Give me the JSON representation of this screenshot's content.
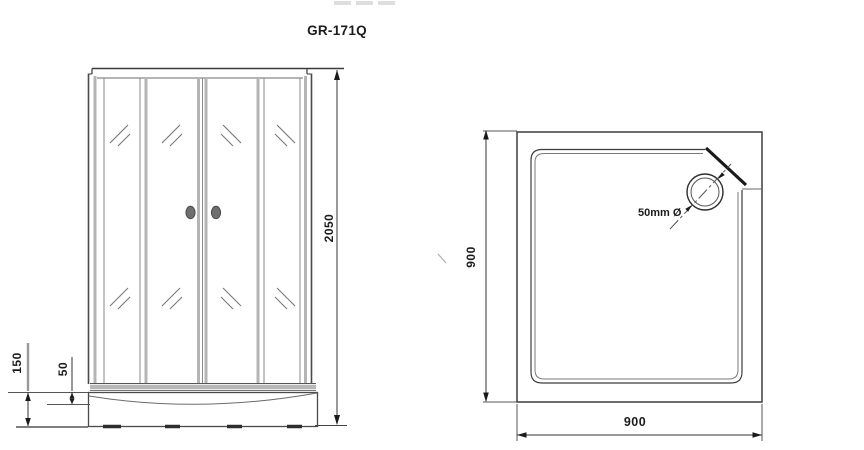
{
  "title": "GR-171Q",
  "views": {
    "front": {
      "name": "shower cabin front elevation",
      "dim_height": "2050",
      "dim_tray_height": "150",
      "dim_tray_depth": "50"
    },
    "plan": {
      "name": "shower tray plan view",
      "dim_width": "900",
      "dim_depth": "900",
      "drain_label": "50mm Ø"
    }
  },
  "colors": {
    "line": "#3d3d3d",
    "light_line": "#b5b5b5",
    "mid_line": "#8a8a8a",
    "knob": "#6e6e6e",
    "background": "#ffffff"
  }
}
